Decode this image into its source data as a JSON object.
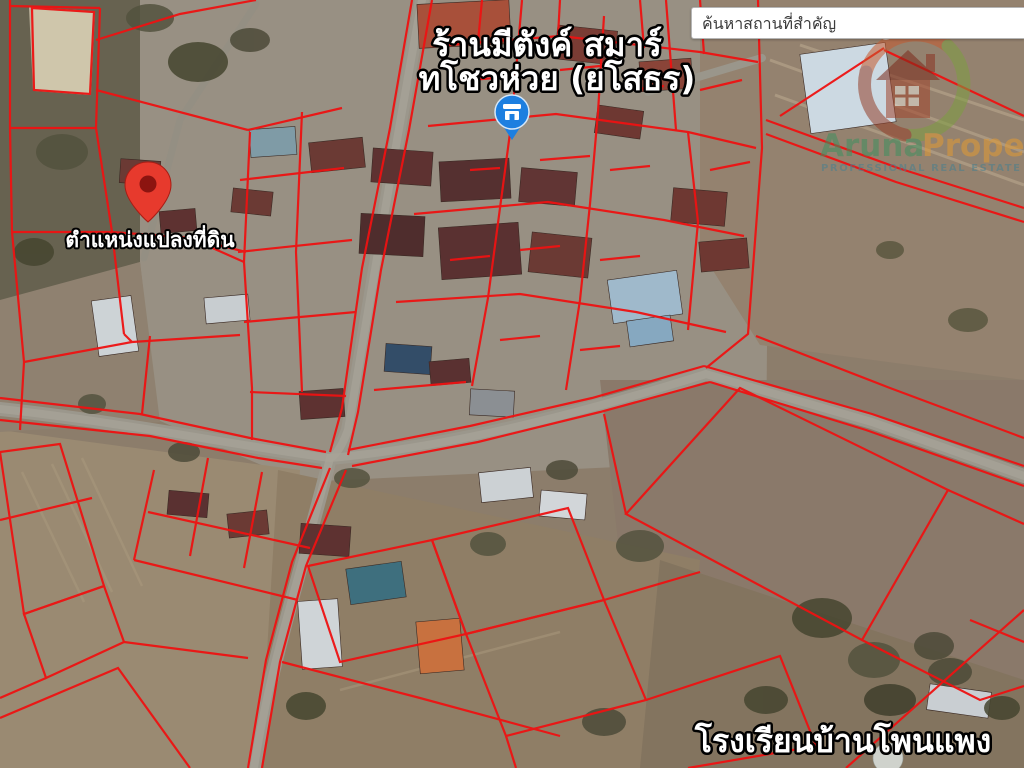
{
  "search": {
    "placeholder": "ค้นหาสถานที่สำคัญ"
  },
  "labels": {
    "shop_line1": "ร้านมีตังค์ สมาร์",
    "shop_line2": "ทโชวห่วย (ยโสธร)",
    "parcel_pin": "ตำแหน่งแปลงที่ดิน",
    "school": "โรงเรียนบ้านโพนแพง"
  },
  "watermark": {
    "brand_first": "Aruna",
    "brand_second": "Property",
    "tagline": "PROFESSIONAL REAL ESTATE AGENT",
    "brand_first_color": "#3f8f5f",
    "brand_second_color": "#e29a34",
    "tagline_color": "#49808e"
  },
  "markers": {
    "parcel_pin_color": "#e73a2d",
    "parcel_pin_hole_color": "#8c1410",
    "poi_pin_color": "#1d7fe0"
  },
  "map": {
    "parcel_line_color": "#ee1212"
  }
}
